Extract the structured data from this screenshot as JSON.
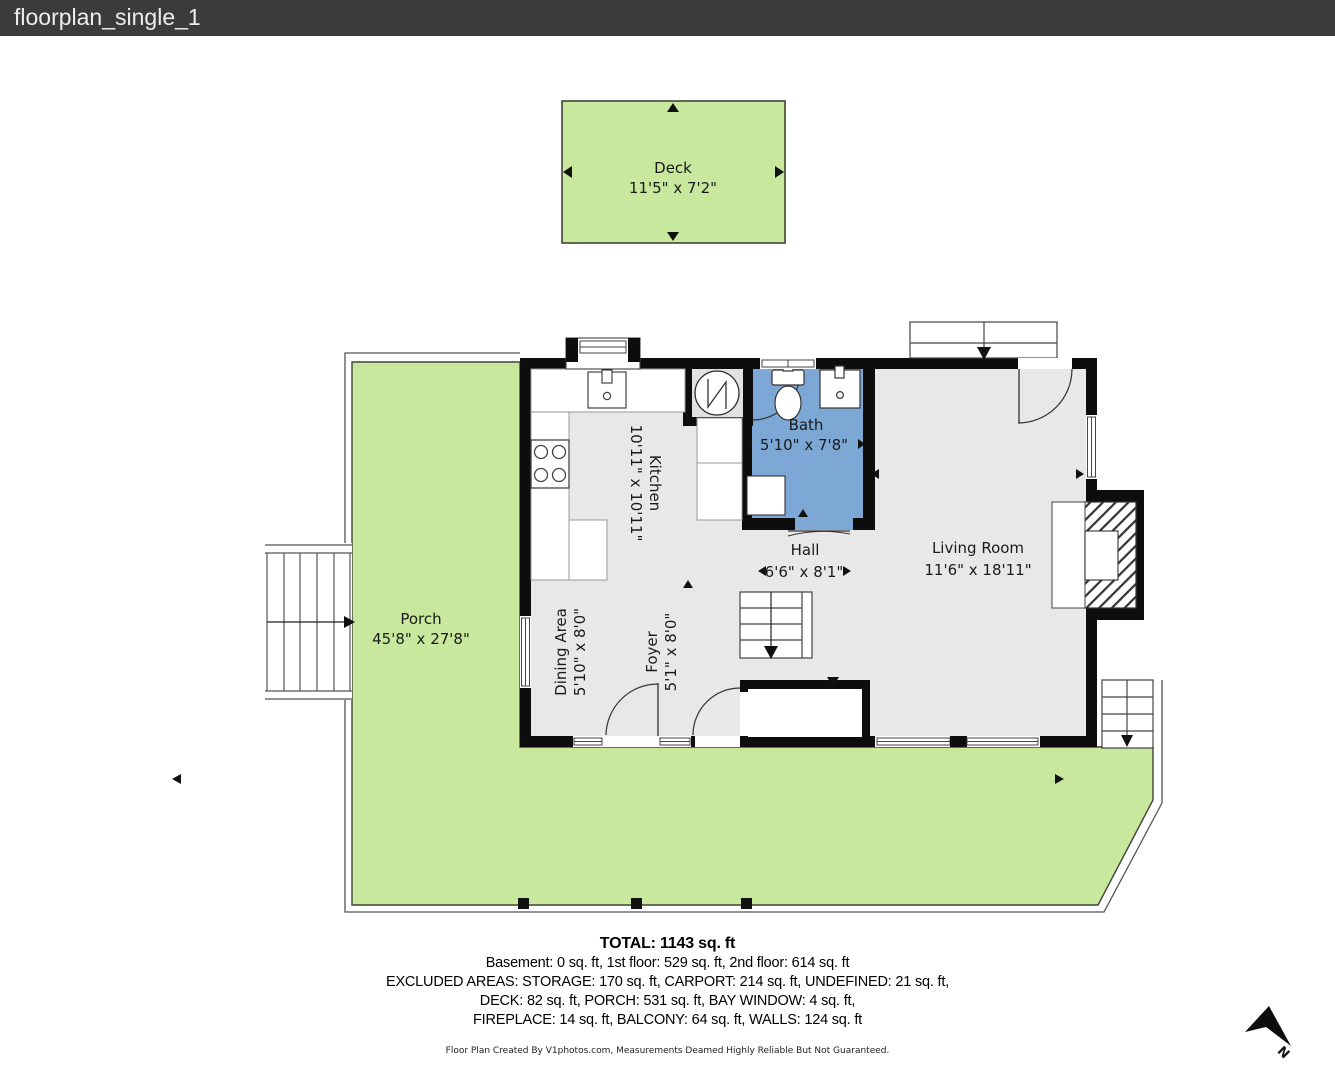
{
  "header": {
    "title": "floorplan_single_1"
  },
  "rooms": {
    "deck": {
      "name": "Deck",
      "dims": "11'5\" x 7'2\""
    },
    "porch": {
      "name": "Porch",
      "dims": "45'8\" x 27'8\""
    },
    "kitchen": {
      "name": "Kitchen",
      "dims": "10'11\" x 10'11\""
    },
    "bath": {
      "name": "Bath",
      "dims": "5'10\" x 7'8\""
    },
    "hall": {
      "name": "Hall",
      "dims": "6'6\" x 8'1\""
    },
    "living_room": {
      "name": "Living Room",
      "dims": "11'6\" x 18'11\""
    },
    "dining_area": {
      "name": "Dining Area",
      "dims": "5'10\" x 8'0\""
    },
    "foyer": {
      "name": "Foyer",
      "dims": "5'1\" x 8'0\""
    }
  },
  "summary": {
    "total": "TOTAL: 1143 sq. ft",
    "line1": "Basement: 0 sq. ft, 1st floor: 529 sq. ft, 2nd floor: 614 sq. ft",
    "line2": "EXCLUDED AREAS: STORAGE: 170 sq. ft, CARPORT: 214 sq. ft, UNDEFINED: 21 sq. ft,",
    "line3": "DECK: 82 sq. ft, PORCH: 531 sq. ft, BAY WINDOW: 4 sq. ft,",
    "line4": "FIREPLACE: 14 sq. ft, BALCONY: 64 sq. ft, WALLS: 124 sq. ft"
  },
  "footer": {
    "credit": "Floor Plan Created By V1photos.com, Measurements Deamed Highly Reliable But Not Guaranteed."
  },
  "compass": {
    "label": "N"
  },
  "colors": {
    "titlebar": "#3b3b3b",
    "porch_green": "#c8e89e",
    "bath_blue": "#7da8d6",
    "wall_black": "#0d0d0d",
    "floor_gray": "#e8e8e8"
  }
}
